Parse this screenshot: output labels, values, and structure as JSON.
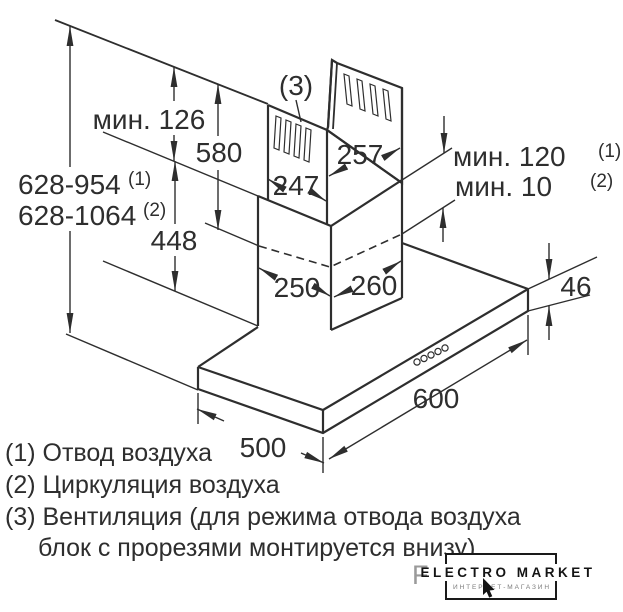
{
  "figure": {
    "callout_3": "(3)",
    "dims": {
      "min_126": "мин. 126",
      "len_580": "580",
      "range_exhaust": "628-954",
      "range_exhaust_sup": "(1)",
      "range_recirc": "628-1064",
      "range_recirc_sup": "(2)",
      "len_448": "448",
      "width_247": "247",
      "depth_257": "257",
      "width_250": "250",
      "depth_260": "260",
      "min_120": "мин. 120",
      "min_120_sup": "(1)",
      "min_10": "мин. 10",
      "min_10_sup": "(2)",
      "thk_46": "46",
      "width_600": "600",
      "depth_500": "500"
    }
  },
  "legend": {
    "item1": "(1) Отвод воздуха",
    "item2": "(2) Циркуляция воздуха",
    "item3_line1": "(3) Вентиляция (для режима отвода воздуха",
    "item3_line2": "блок с прорезями монтируется внизу)"
  },
  "watermark": {
    "letter": "F",
    "title": "ELECTRO MARKET",
    "subtitle": "ИНТЕРНЕТ-МАГАЗИН"
  },
  "colors": {
    "line": "#2e2e2e",
    "background": "#ffffff",
    "watermark_gray": "#9a9a9a"
  }
}
